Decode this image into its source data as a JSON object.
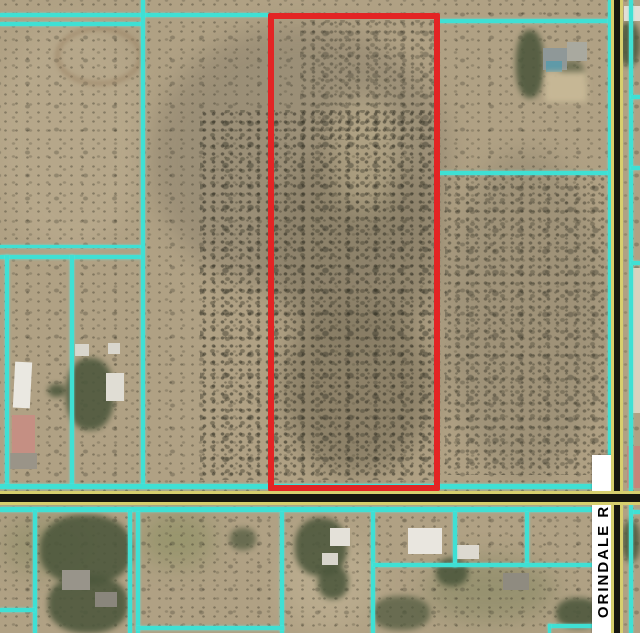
{
  "map": {
    "type": "aerial-parcel-map",
    "road_label": "ORINDALE RD",
    "highlighted_parcel": {
      "description": "red outlined vacant land parcel north of the east-west road",
      "outline_color": "#e32424"
    },
    "colors": {
      "parcel_line": "#3fe0d4",
      "highlight_outline": "#e32424",
      "road_stripe_yellow": "#d6cf6e",
      "road_core_black": "#17170f",
      "label_bg": "#ffffff",
      "label_text": "#000000",
      "terrain_base": "#b0a184"
    }
  }
}
